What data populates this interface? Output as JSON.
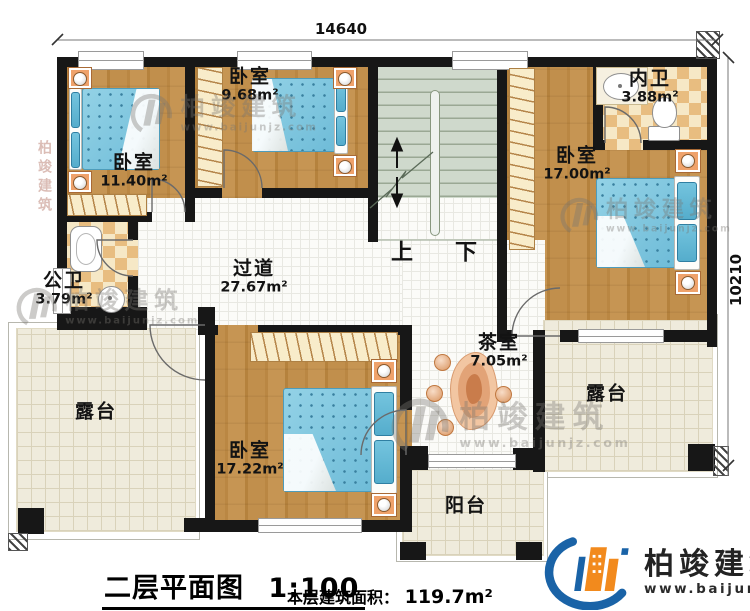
{
  "dimensions": {
    "width": "14640",
    "height": "10210"
  },
  "stairs": {
    "up": "上",
    "down": "下"
  },
  "rooms": {
    "bedroom_tl": {
      "name": "卧室",
      "area": "11.40m²"
    },
    "bedroom_tm": {
      "name": "卧室",
      "area": "9.68m²"
    },
    "bath_inner": {
      "name": "内卫",
      "area": "3.88m²"
    },
    "bedroom_right": {
      "name": "卧室",
      "area": "17.00m²"
    },
    "bath_public": {
      "name": "公卫",
      "area": "3.79m²"
    },
    "hallway": {
      "name": "过道",
      "area": "27.67m²"
    },
    "tea_room": {
      "name": "茶室",
      "area": "7.05m²"
    },
    "bedroom_bottom": {
      "name": "卧室",
      "area": "17.22m²"
    },
    "terrace_left": {
      "name": "露台"
    },
    "terrace_right": {
      "name": "露台"
    },
    "balcony": {
      "name": "阳台"
    }
  },
  "footer": {
    "title": "二层平面图",
    "scale": "1:100",
    "area_label": "本层建筑面积：",
    "area_value": "119.7m²"
  },
  "brand": {
    "name": "柏竣建筑",
    "url": "www.baijunjz.com"
  },
  "watermark": {
    "text": "柏竣建筑",
    "url": "www.baijunjz.com"
  }
}
